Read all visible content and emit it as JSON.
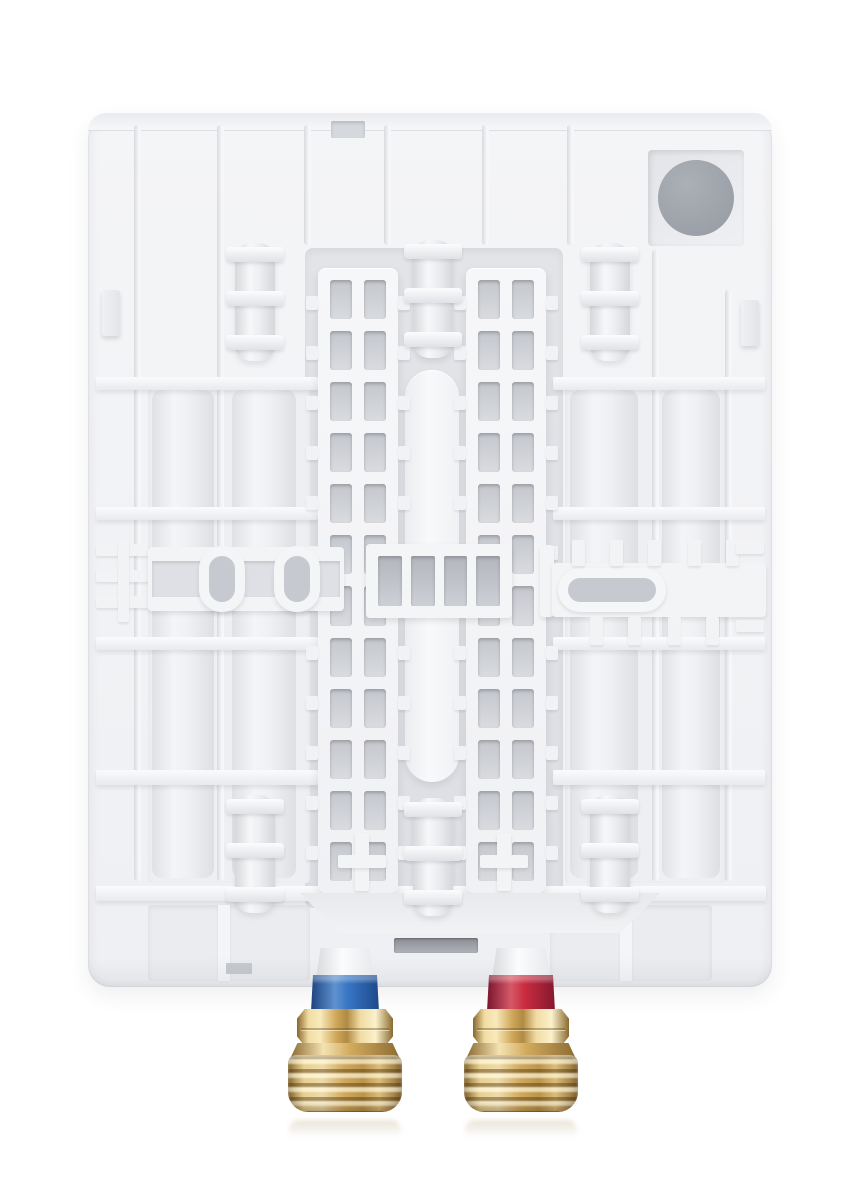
{
  "meta": {
    "subject": "Rear view of a white tankless water heater backplate with mounting ribs, clips, keyhole slots and two brass pipe connections",
    "background_color": "#ffffff"
  },
  "housing": {
    "base_color": "#f2f3f6",
    "panel_color": "#edeff2",
    "recess_color": "#e0e2e6",
    "hole_color": "#c6c9cf"
  },
  "cable_entry": {
    "grommet_color": "#9ba0a8"
  },
  "vent_slot": {
    "color": "#a2a6ad"
  },
  "mounting_grids": {
    "count": 2,
    "columns": 2,
    "rows": 12,
    "outer_teeth_per_side": 12
  },
  "clips": {
    "count": 6,
    "bands_per_clip": 3
  },
  "keyhole_rings": {
    "count": 2
  },
  "window_slots": {
    "count": 4
  },
  "connections": {
    "cold_inlet": {
      "side": "left",
      "ring_color": "#2e6fc1"
    },
    "hot_outlet": {
      "side": "right",
      "ring_color": "#c82438"
    },
    "brass": {
      "light": "#f1dea7",
      "mid": "#d4ad60",
      "dark": "#8a6a30"
    }
  }
}
